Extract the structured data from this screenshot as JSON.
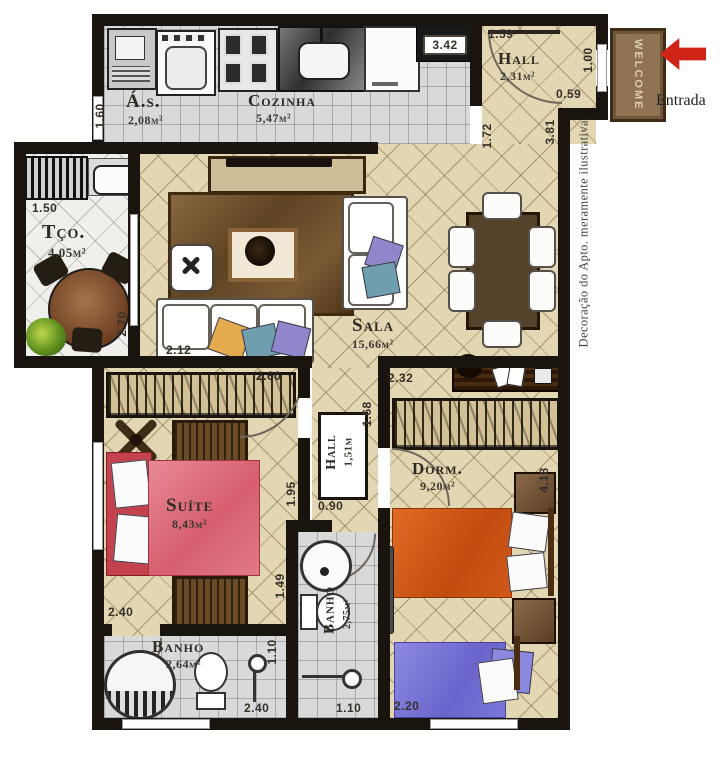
{
  "rooms": {
    "as": {
      "name": "Á.s.",
      "area": "2,08m²"
    },
    "cozinha": {
      "name": "Cozinha",
      "area": "5,47m²"
    },
    "hall_in": {
      "name": "Hall",
      "area": "2,31m²"
    },
    "tco": {
      "name": "Tço.",
      "area": "4,05m²"
    },
    "sala": {
      "name": "Sala",
      "area": "15,66m²"
    },
    "suite": {
      "name": "Suíte",
      "area": "8,43m²"
    },
    "hall_int": {
      "name": "Hall",
      "area": "1,51m"
    },
    "dorm": {
      "name": "Dorm.",
      "area": "9,20m²"
    },
    "banho1": {
      "name": "Banho",
      "area": "2,64m²"
    },
    "banho2": {
      "name": "Banho",
      "area": "2,75m²"
    }
  },
  "dims": {
    "hall_top": "1.59",
    "kitchen_width": "3.42",
    "entry_door": "1.00",
    "hall_side": "0.59",
    "as_left": "1.60",
    "terrace_top": "1.50",
    "terrace_right": "2.70",
    "sala_right_a": "1.72",
    "sala_right_b": "3.81",
    "sofa_front": "2.12",
    "suite_top": "2.60",
    "dorm_top": "2.32",
    "hall_int_right": "1.68",
    "hall_int_left": "1.95",
    "banho2_top": "0.90",
    "banho2_left_a": "1.49",
    "banho2_left_b": "1.10",
    "suite_bottom": "2.40",
    "banho1_bottom": "2.40",
    "banho2_bottom": "1.10",
    "dorm_bottom": "2.20",
    "dorm_right": "4.18"
  },
  "annotations": {
    "entrance_label": "Entrada",
    "doormat": "WELCOME",
    "disclaimer": "Decoração do Apto. meramente ilustrativa."
  },
  "colors": {
    "wall": "#19140e",
    "floor_beige": "#e3d6b2",
    "floor_tile": "#d9d9d9",
    "suite_bed": "#df7280",
    "dorm_bed_orange": "#d2581a",
    "dorm_bed_blue": "#7b76d9",
    "entry_arrow_red": "#d02418",
    "rug_brown": "#6e4e2c"
  }
}
